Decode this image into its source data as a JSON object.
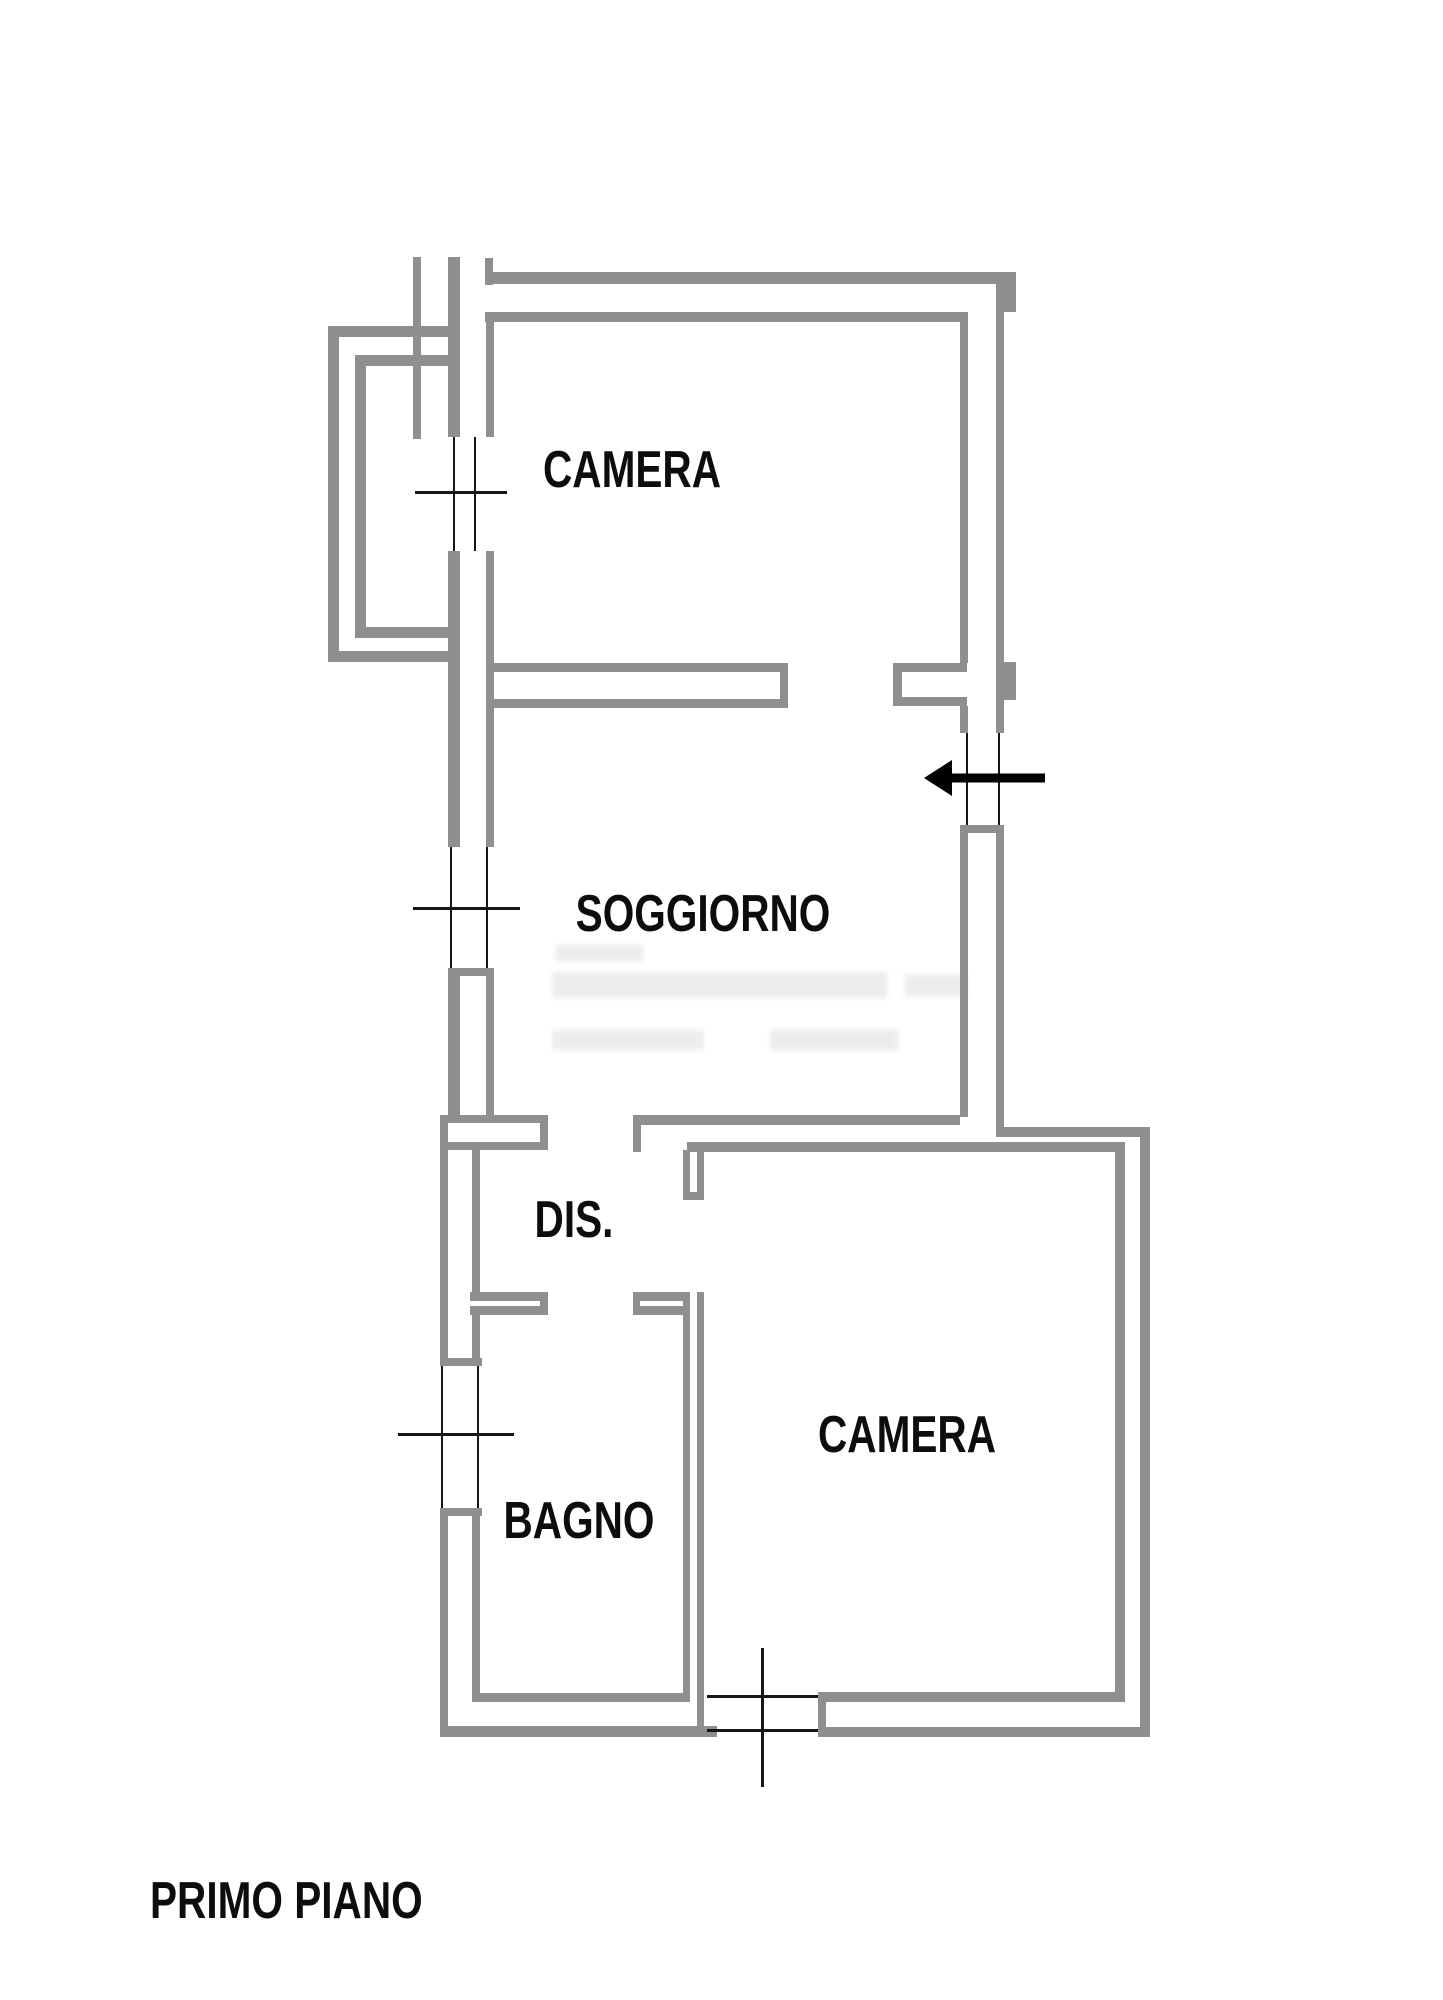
{
  "document": {
    "floor_title": "PRIMO PIANO"
  },
  "rooms": [
    {
      "name": "CAMERA"
    },
    {
      "name": "SOGGIORNO"
    },
    {
      "name": "DIS."
    },
    {
      "name": "CAMERA"
    },
    {
      "name": "BAGNO"
    }
  ],
  "floorplan": {
    "canvas": {
      "width": 1443,
      "height": 2000,
      "background": "#ffffff"
    },
    "wall_color": "#8f8f8f",
    "line_color": "#161616",
    "walls": [
      [
        413,
        257,
        8,
        182
      ],
      [
        485,
        258,
        8,
        27
      ],
      [
        493,
        272,
        523,
        12
      ],
      [
        1004,
        272,
        12,
        40
      ],
      [
        996,
        284,
        8,
        416
      ],
      [
        1004,
        662,
        12,
        38
      ],
      [
        485,
        312,
        483,
        10
      ],
      [
        960,
        322,
        8,
        341
      ],
      [
        893,
        663,
        74,
        9
      ],
      [
        893,
        697,
        74,
        9
      ],
      [
        893,
        663,
        9,
        43
      ],
      [
        960,
        706,
        8,
        27
      ],
      [
        996,
        700,
        8,
        33
      ],
      [
        960,
        825,
        44,
        8
      ],
      [
        960,
        833,
        8,
        284
      ],
      [
        996,
        833,
        8,
        294
      ],
      [
        448,
        257,
        12,
        180
      ],
      [
        486,
        312,
        8,
        125
      ],
      [
        448,
        551,
        12,
        296
      ],
      [
        486,
        551,
        8,
        296
      ],
      [
        486,
        663,
        302,
        9
      ],
      [
        494,
        699,
        294,
        9
      ],
      [
        780,
        663,
        8,
        45
      ],
      [
        328,
        326,
        124,
        11
      ],
      [
        328,
        326,
        11,
        336
      ],
      [
        328,
        651,
        124,
        11
      ],
      [
        355,
        355,
        101,
        11
      ],
      [
        355,
        355,
        11,
        283
      ],
      [
        355,
        627,
        101,
        11
      ],
      [
        448,
        968,
        12,
        147
      ],
      [
        486,
        968,
        8,
        147
      ],
      [
        448,
        968,
        46,
        8
      ],
      [
        440,
        1115,
        108,
        8
      ],
      [
        440,
        1142,
        108,
        8
      ],
      [
        440,
        1115,
        8,
        35
      ],
      [
        540,
        1115,
        8,
        35
      ],
      [
        440,
        1150,
        8,
        142
      ],
      [
        472,
        1150,
        8,
        142
      ],
      [
        470,
        1292,
        78,
        9
      ],
      [
        470,
        1306,
        78,
        9
      ],
      [
        540,
        1292,
        8,
        23
      ],
      [
        440,
        1292,
        8,
        66
      ],
      [
        472,
        1315,
        8,
        43
      ],
      [
        440,
        1358,
        42,
        8
      ],
      [
        440,
        1508,
        42,
        8
      ],
      [
        440,
        1516,
        8,
        221
      ],
      [
        472,
        1516,
        8,
        177
      ],
      [
        472,
        1693,
        218,
        9
      ],
      [
        440,
        1726,
        277,
        11
      ],
      [
        683,
        1292,
        7,
        410
      ],
      [
        697,
        1292,
        7,
        434
      ],
      [
        633,
        1292,
        50,
        9
      ],
      [
        633,
        1306,
        50,
        9
      ],
      [
        633,
        1292,
        7,
        23
      ],
      [
        683,
        1150,
        7,
        50
      ],
      [
        697,
        1150,
        7,
        50
      ],
      [
        683,
        1192,
        21,
        8
      ],
      [
        633,
        1115,
        327,
        10
      ],
      [
        687,
        1142,
        438,
        10
      ],
      [
        633,
        1115,
        8,
        37
      ],
      [
        996,
        1127,
        152,
        10
      ],
      [
        1140,
        1127,
        10,
        610
      ],
      [
        1115,
        1142,
        10,
        560
      ],
      [
        818,
        1692,
        297,
        10
      ],
      [
        818,
        1692,
        8,
        45
      ],
      [
        818,
        1727,
        332,
        10
      ]
    ],
    "window_lines": [
      [
        966,
        733,
        2,
        92
      ],
      [
        998,
        733,
        2,
        92
      ],
      [
        453,
        437,
        2,
        114
      ],
      [
        474,
        437,
        2,
        114
      ],
      [
        415,
        491,
        92,
        3
      ],
      [
        450,
        847,
        2,
        121
      ],
      [
        486,
        847,
        2,
        121
      ],
      [
        413,
        907,
        107,
        3
      ],
      [
        441,
        1366,
        2,
        142
      ],
      [
        477,
        1366,
        2,
        142
      ],
      [
        398,
        1433,
        116,
        3
      ],
      [
        707,
        1695,
        111,
        3
      ],
      [
        707,
        1729,
        111,
        3
      ],
      [
        761,
        1648,
        3,
        139
      ]
    ],
    "arrow": {
      "shaft": [
        940,
        778,
        1045,
        778
      ],
      "shaft_width": 9,
      "head": [
        [
          924,
          778
        ],
        [
          952,
          760
        ],
        [
          952,
          796
        ]
      ]
    },
    "watermark": {
      "color": "#dedede",
      "bars": [
        [
          555,
          945,
          88,
          16
        ],
        [
          552,
          972,
          335,
          26
        ],
        [
          905,
          975,
          62,
          22
        ],
        [
          552,
          1030,
          152,
          20
        ],
        [
          770,
          1030,
          128,
          20
        ]
      ]
    }
  }
}
